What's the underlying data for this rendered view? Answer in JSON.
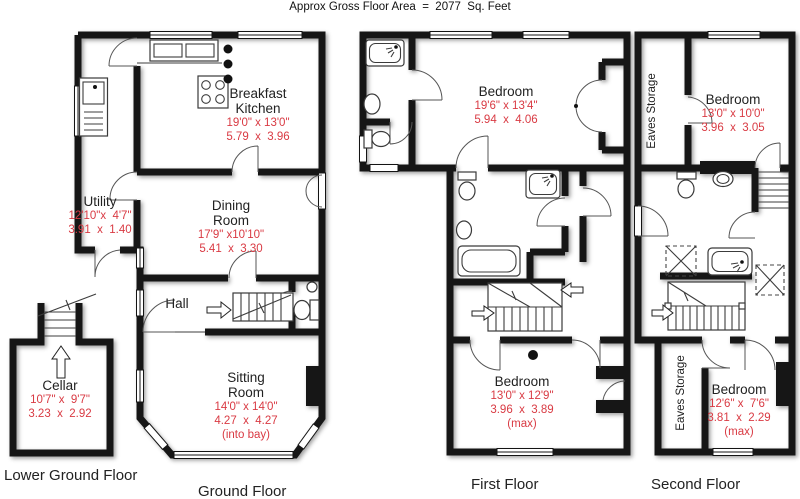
{
  "header": {
    "title": "Approx Gross Floor Area  =  2077  Sq. Feet"
  },
  "accent": {
    "dimension_text": "#d93a43",
    "wall": "#161616",
    "background": "#ffffff"
  },
  "floors": {
    "lower_ground": {
      "caption": "Lower Ground Floor",
      "cellar": {
        "name": "Cellar",
        "imperial": "10'7\" x  9'7\"",
        "metric": "3.23  x  2.92"
      }
    },
    "ground": {
      "caption": "Ground Floor",
      "breakfast_kitchen": {
        "name": "Breakfast Kitchen",
        "imperial": "19'0\" x 13'0\"",
        "metric": "5.79  x  3.96"
      },
      "utility": {
        "name": "Utility",
        "imperial": "12'10\"x  4'7\"",
        "metric": "3.91  x  1.40"
      },
      "dining_room": {
        "name": "Dining Room",
        "imperial": "17'9\" x10'10\"",
        "metric": "5.41  x  3.30"
      },
      "hall": {
        "name": "Hall"
      },
      "sitting_room": {
        "name": "Sitting Room",
        "imperial": "14'0\" x 14'0\"",
        "metric": "4.27  x  4.27",
        "note": "(into bay)"
      }
    },
    "first": {
      "caption": "First Floor",
      "bedroom_front": {
        "name": "Bedroom",
        "imperial": "19'6\" x 13'4\"",
        "metric": "5.94  x  4.06"
      },
      "bedroom_rear": {
        "name": "Bedroom",
        "imperial": "13'0\" x 12'9\"",
        "metric": "3.96  x  3.89",
        "note": "(max)"
      }
    },
    "second": {
      "caption": "Second Floor",
      "eaves_front": {
        "name": "Eaves Storage"
      },
      "bedroom_front": {
        "name": "Bedroom",
        "imperial": "13'0\" x 10'0\"",
        "metric": "3.96  x  3.05"
      },
      "eaves_rear": {
        "name": "Eaves Storage"
      },
      "bedroom_rear": {
        "name": "Bedroom",
        "imperial": "12'6\" x  7'6\"",
        "metric": "3.81  x  2.29",
        "note": "(max)"
      }
    }
  }
}
